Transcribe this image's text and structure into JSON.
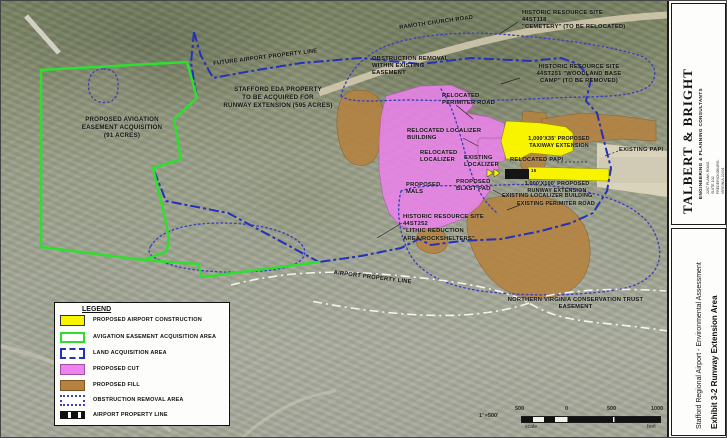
{
  "map": {
    "labels": {
      "ramoth_road": {
        "text": "RAMOTH CHURCH ROAD"
      },
      "historic_cemetery": {
        "text": "HISTORIC RESOURCE SITE\n44ST118\n\"CEMETERY\" (TO BE RELOCATED)"
      },
      "historic_woodland": {
        "text": "HISTORIC RESOURCE SITE\n44ST251 \"WOODLAND BASE\nCAMP\" (TO BE REMOVED)"
      },
      "obstruction_easement": {
        "text": "OBSTRUCTION REMOVAL\nWITHIN EXISTING\nEASEMENT"
      },
      "future_property_line": {
        "text": "FUTURE AIRPORT PROPERTY LINE"
      },
      "stafford_eda": {
        "text": "STAFFORD EDA PROPERTY\nTO BE ACQUIRED FOR\nRUNWAY EXTENSION (595 ACRES)"
      },
      "avigation_easement": {
        "text": "PROPOSED AVIGATION\nEASEMENT ACQUISITION\n(91 ACRES)"
      },
      "relocated_perimiter_road": {
        "text": "RELOCATED\nPERIMITER ROAD"
      },
      "relocated_localizer_building": {
        "text": "RELOCATED LOCALIZER\nBUILDING"
      },
      "relocated_localizer": {
        "text": "RELOCATED\nLOCALIZER"
      },
      "existing_localizer": {
        "text": "EXISTING\nLOCALIZER"
      },
      "proposed_mals": {
        "text": "PROPOSED\nMALS"
      },
      "proposed_blast_pad": {
        "text": "PROPOSED\nBLAST PAD"
      },
      "taxiway_extension": {
        "text": "1,000'X35' PROPOSED\nTAXIWAY EXTENSION"
      },
      "relocated_papi": {
        "text": "RELOCATED PAPI"
      },
      "existing_papi": {
        "text": "EXISTING PAPI"
      },
      "runway_extension": {
        "text": "1,000'X100' PROPOSED\nRUNWAY EXTENSION"
      },
      "existing_localizer_building": {
        "text": "EXISTING LOCALIZER BUILDING"
      },
      "existing_perimiter_road": {
        "text": "EXISTING PERIMITER ROAD"
      },
      "historic_lithic": {
        "text": "HISTORIC RESOURCE SITE\n44ST252\n\"LITHIC REDUCTION\nAREA/ROCKSHELTERS\""
      },
      "airport_property_line": {
        "text": "AIRPORT PROPERTY LINE"
      },
      "nova_trust": {
        "text": "NORTHERN VIRGINIA CONSERVATION TRUST\nEASEMENT"
      },
      "runway_number": {
        "text": "15"
      }
    }
  },
  "legend": {
    "title": "LEGEND",
    "items": [
      {
        "label": "PROPOSED AIRPORT CONSTRUCTION",
        "swatch": "yellow-fill"
      },
      {
        "label": "AVIGATION EASEMENT ACQUISITION AREA",
        "swatch": "green-outline"
      },
      {
        "label": "LAND ACQUISITION AREA",
        "swatch": "blue-dash-dot-outline"
      },
      {
        "label": "PROPOSED CUT",
        "swatch": "magenta-fill"
      },
      {
        "label": "PROPOSED FILL",
        "swatch": "brown-fill"
      },
      {
        "label": "OBSTRUCTION REMOVAL AREA",
        "swatch": "blue-dotted-outline"
      },
      {
        "label": "AIRPORT PROPERTY LINE",
        "swatch": "black-dash-line"
      }
    ]
  },
  "scalebar": {
    "ratio": "1\"=500'",
    "ticks": [
      "500",
      "0",
      "500",
      "1000"
    ],
    "scale_word": "scale",
    "feet_word": "feet"
  },
  "sidebar": {
    "firm": "TALBERT & BRIGHT",
    "firm_sub": "ENGINEERING & PLANNING CONSULTANTS",
    "firm_lines": "2207 PLANK ROAD, SUITE 102\nFREDERICKSBURG, VIRGINIA 22401\nPH: 540-891-8688   FAX: 540-891-8689",
    "project": "Stafford Regional Airport - Environmental Assessment",
    "exhibit": "Exhibit 3-2   Runway Extension Area"
  },
  "colors": {
    "proposed_construction": "#f8f400",
    "avigation_easement": "#2ee02e",
    "land_acquisition": "#2431b8",
    "proposed_cut": "#ee82ee",
    "proposed_fill": "#b5823f",
    "obstruction_removal": "#4040bb",
    "airport_property_line": "#111111",
    "property_line_map": "#f5f5f0"
  }
}
